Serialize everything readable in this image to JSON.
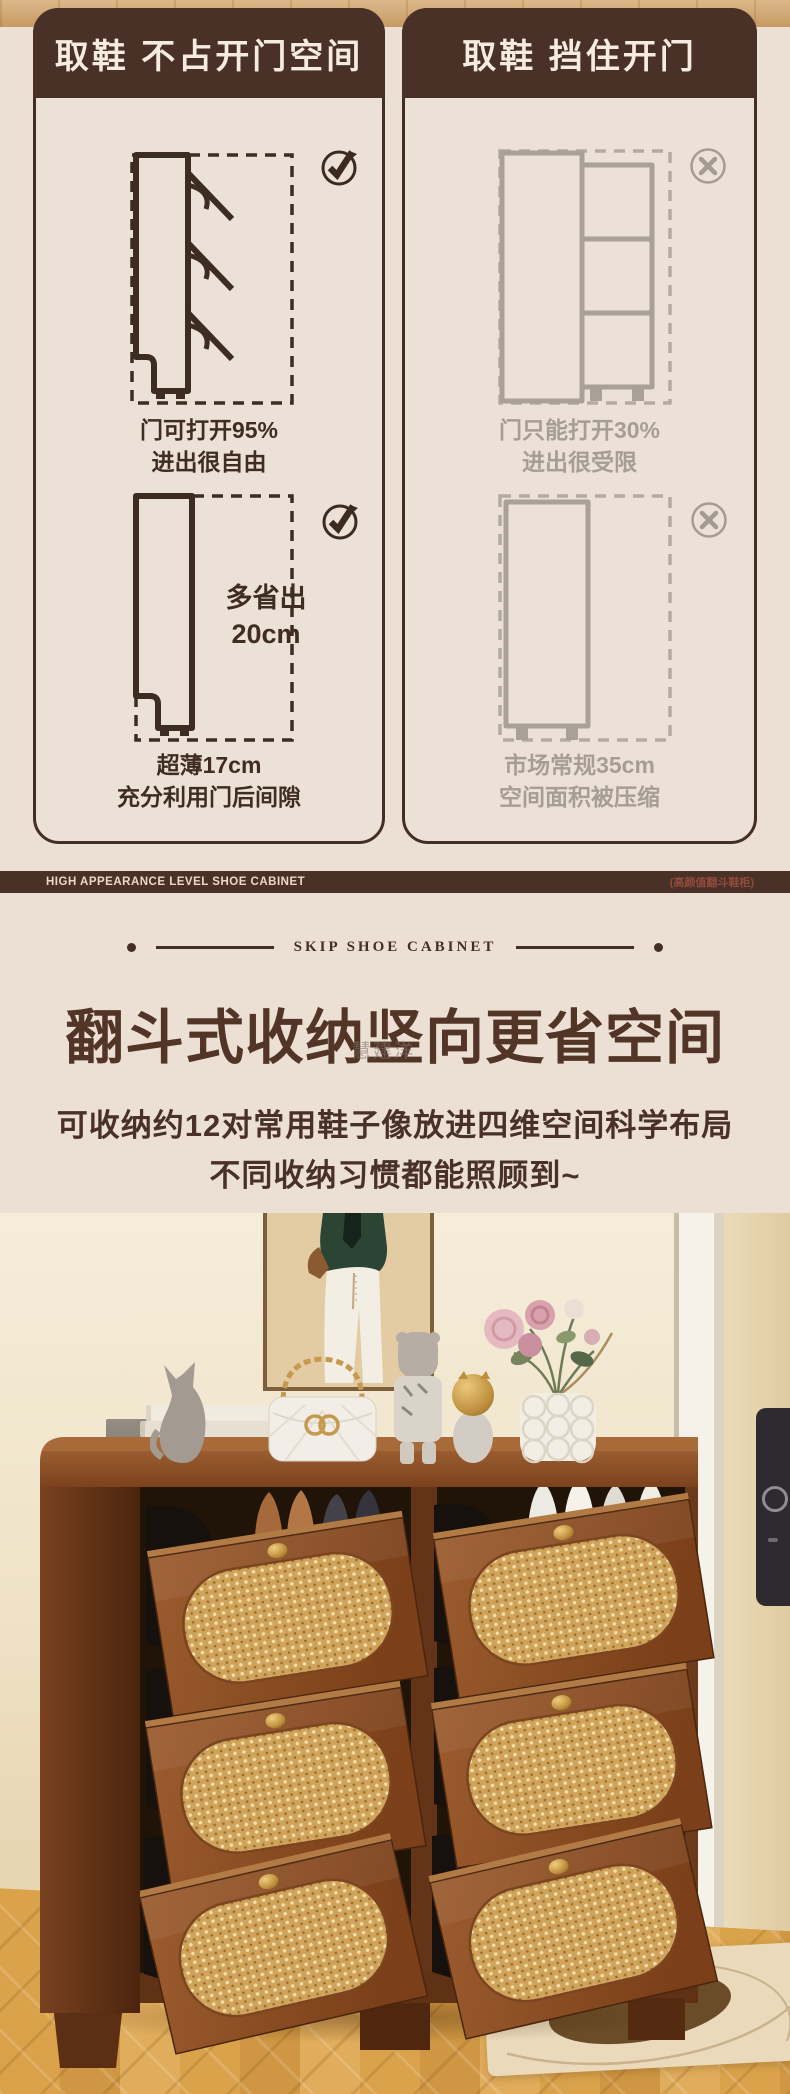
{
  "comparison": {
    "good": {
      "title": "取鞋 不占开门空间",
      "cap1_l1": "门可打开95%",
      "cap1_l2": "进出很自由",
      "save_l1": "多省出",
      "save_l2": "20cm",
      "cap2_l1": "超薄17cm",
      "cap2_l2": "充分利用门后间隙"
    },
    "bad": {
      "title": "取鞋 挡住开门",
      "cap1_l1": "门只能打开30%",
      "cap1_l2": "进出很受限",
      "cap2_l1": "市场常规35cm",
      "cap2_l2": "空间面积被压缩"
    }
  },
  "banner": {
    "left": "HIGH APPEARANCE LEVEL SHOE CABINET",
    "right": "(高颜值翻斗鞋柜)"
  },
  "intro": {
    "eyebrow": "SKIP SHOE CABINET",
    "title": "翻斗式收纳竖向更省空间",
    "watermark": "慧建洋",
    "line1": "可收纳约12对常用鞋子像放进四维空间科学布局",
    "line2": "不同收纳习惯都能照顾到~"
  },
  "colors": {
    "brown": "#4a3127",
    "cream": "#ece0d5",
    "panel_cream": "#ece1d7",
    "text_dark": "#3f2d22",
    "text_gray": "#a69d94",
    "gold": "#c59a4e"
  }
}
